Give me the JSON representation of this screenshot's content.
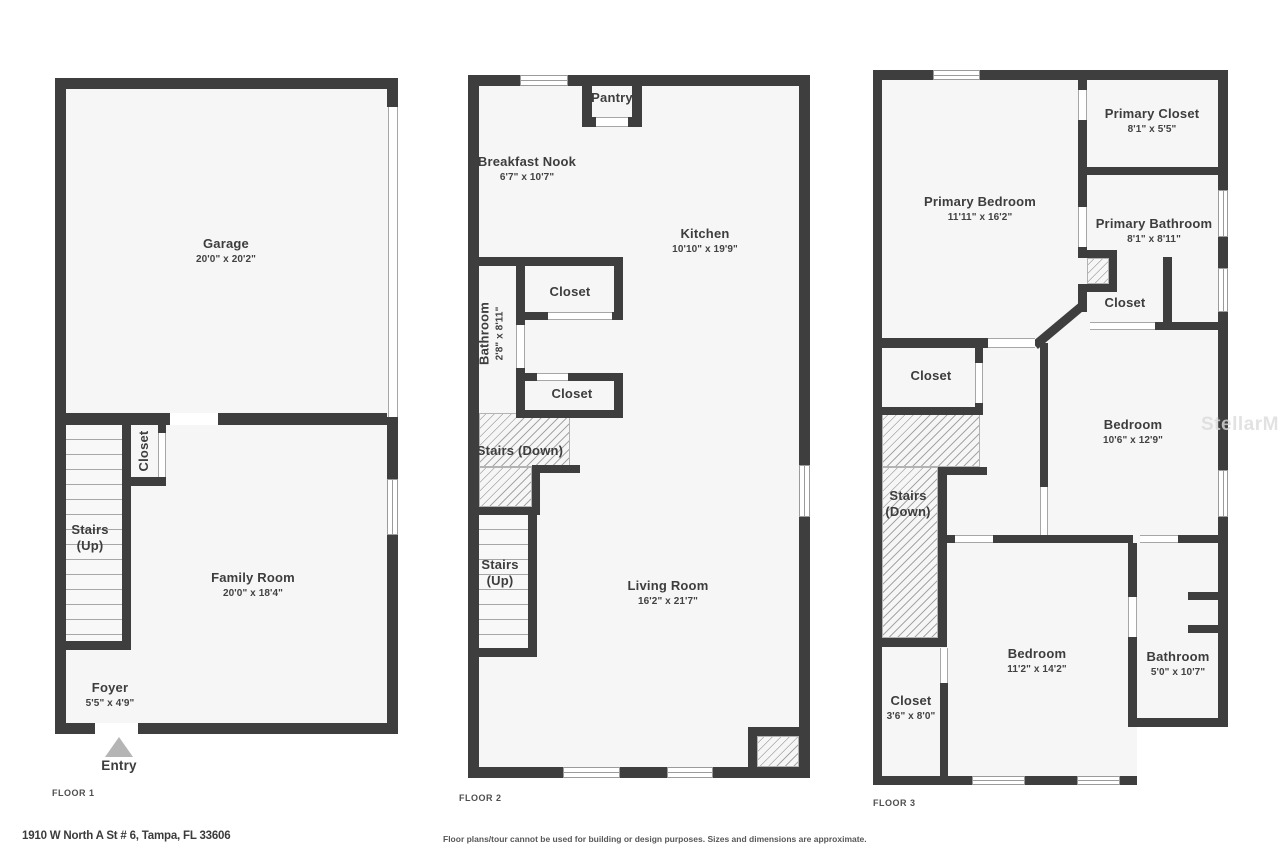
{
  "address": "1910 W North A St # 6, Tampa, FL 33606",
  "disclaimer": "Floor plans/tour cannot be used for building or design purposes. Sizes and dimensions are approximate.",
  "watermark": "StellarMLS",
  "colors": {
    "wall": "#3e3e3e",
    "floor_fill": "#f6f6f6",
    "line": "#9b9b9b",
    "text": "#3d3d3d",
    "entry_arrow": "#b5b5b5"
  },
  "floor1": {
    "label": "FLOOR 1",
    "entry": "Entry",
    "rooms": {
      "garage": {
        "name": "Garage",
        "dims": "20'0\" x 20'2\""
      },
      "stairs": {
        "name": "Stairs",
        "sub": "(Up)"
      },
      "closet": {
        "name": "Closet"
      },
      "family": {
        "name": "Family Room",
        "dims": "20'0\" x 18'4\""
      },
      "foyer": {
        "name": "Foyer",
        "dims": "5'5\" x 4'9\""
      }
    }
  },
  "floor2": {
    "label": "FLOOR 2",
    "rooms": {
      "pantry": {
        "name": "Pantry"
      },
      "breakfast": {
        "name": "Breakfast Nook",
        "dims": "6'7\" x 10'7\""
      },
      "kitchen": {
        "name": "Kitchen",
        "dims": "10'10\" x 19'9\""
      },
      "bathroom": {
        "name": "Bathroom",
        "dims": "2'8\" x 8'11\""
      },
      "closet_upper": {
        "name": "Closet"
      },
      "closet_lower": {
        "name": "Closet"
      },
      "stairs_down": {
        "name": "Stairs (Down)"
      },
      "stairs_up": {
        "name": "Stairs",
        "sub": "(Up)"
      },
      "living": {
        "name": "Living Room",
        "dims": "16'2\" x 21'7\""
      }
    }
  },
  "floor3": {
    "label": "FLOOR 3",
    "rooms": {
      "primary_bedroom": {
        "name": "Primary Bedroom",
        "dims": "11'11\" x 16'2\""
      },
      "primary_closet": {
        "name": "Primary Closet",
        "dims": "8'1\" x 5'5\""
      },
      "primary_bathroom": {
        "name": "Primary Bathroom",
        "dims": "8'1\" x 8'11\""
      },
      "closet_suite": {
        "name": "Closet"
      },
      "closet_hall": {
        "name": "Closet"
      },
      "stairs_down": {
        "name": "Stairs",
        "sub": "(Down)"
      },
      "bedroom2": {
        "name": "Bedroom",
        "dims": "10'6\" x 12'9\""
      },
      "bedroom3": {
        "name": "Bedroom",
        "dims": "11'2\" x 14'2\""
      },
      "bathroom": {
        "name": "Bathroom",
        "dims": "5'0\" x 10'7\""
      },
      "closet_bottom": {
        "name": "Closet",
        "dims": "3'6\" x 8'0\""
      }
    }
  }
}
